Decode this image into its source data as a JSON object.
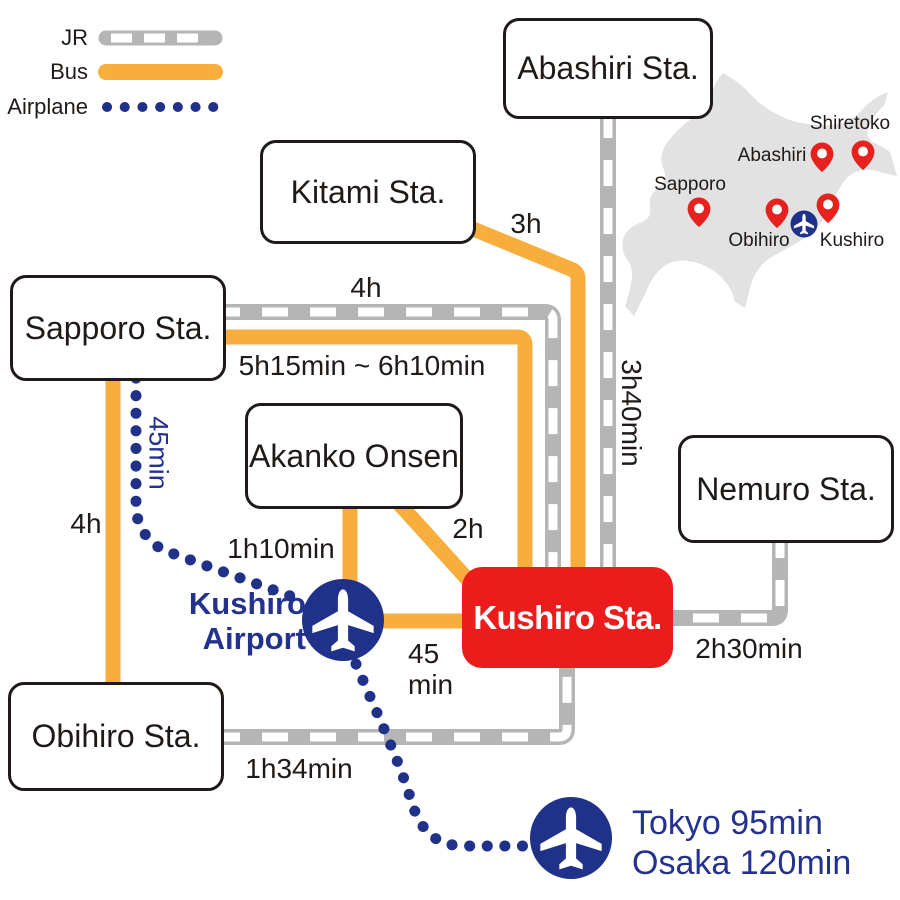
{
  "legend": {
    "jr_label": "JR",
    "bus_label": "Bus",
    "airplane_label": "Airplane"
  },
  "stations": {
    "abashiri": "Abashiri Sta.",
    "kitami": "Kitami Sta.",
    "sapporo": "Sapporo Sta.",
    "akanko_onsen": "Akanko Onsen",
    "nemuro": "Nemuro Sta.",
    "obihiro": "Obihiro Sta.",
    "kushiro": "Kushiro Sta."
  },
  "airport": {
    "name_line1": "Kushiro",
    "name_line2": "Airport",
    "bus_time_line1": "45",
    "bus_time_line2": "min",
    "flight_tokyo": "Tokyo 95min",
    "flight_osaka": "Osaka 120min"
  },
  "durations": {
    "kitami_to_kushiro_bus": "3h",
    "sapporo_to_kushiro_jr": "4h",
    "sapporo_to_kushiro_bus": "5h15min ~ 6h10min",
    "abashiri_to_kushiro_jr": "3h40min",
    "akanko_to_kushiro_bus": "2h",
    "akanko_to_airport_bus": "1h10min",
    "nemuro_to_kushiro_jr": "2h30min",
    "obihiro_to_kushiro_jr": "1h34min",
    "sapporo_to_obihiro_bus": "4h",
    "sapporo_to_airport_flight": "45min"
  },
  "minimap": {
    "labels": {
      "shiretoko": "Shiretoko",
      "abashiri": "Abashiri",
      "sapporo": "Sapporo",
      "obihiro": "Obihiro",
      "kushiro": "Kushiro"
    }
  },
  "colors": {
    "bus_orange": "#F7AE3D",
    "jr_gray": "#B5B5B5",
    "airplane_navy": "#1F3188",
    "highlight_red": "#ED1C1C",
    "map_gray": "#E2E2E2"
  }
}
